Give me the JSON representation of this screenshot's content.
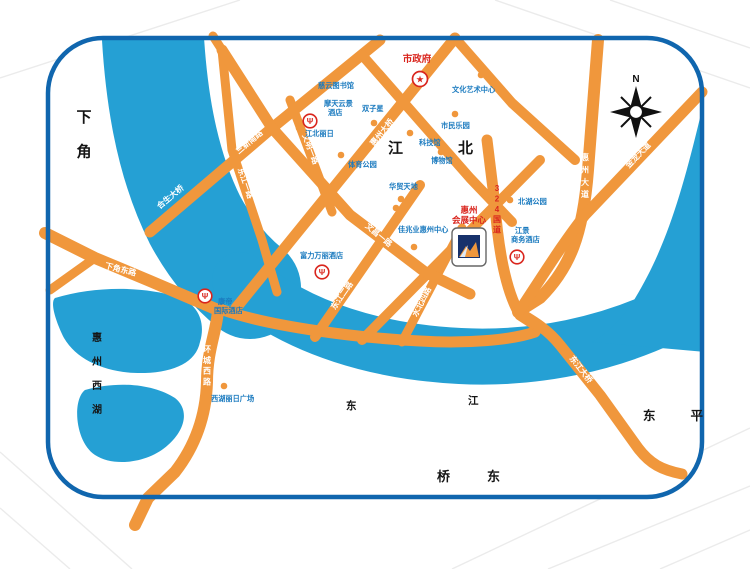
{
  "map": {
    "compass_label": "N",
    "icons": {
      "hotel_marker_glyph": "Ψ",
      "city_hall_star": "★"
    },
    "colors": {
      "border_blue": "#1066ae",
      "water_blue": "#25a0d4",
      "road_orange": "#f0973c",
      "poi_blue": "#1a7abf",
      "accent_red": "#d9251d"
    },
    "districts": {
      "xiajiao": "下角",
      "jiangbei": "江北",
      "qiaodong": "桥东",
      "dongping": "东平",
      "west_lake": "惠州西湖",
      "dongjiang_river": [
        "东",
        "江"
      ]
    },
    "roads": {
      "hesheng_bridge": "合生大桥",
      "sanxin_south_rd": "三新南路",
      "dongjiang_1st_rd": "东江一路",
      "huizhou_bridge": "惠州大桥",
      "wenming_1st_rd": "文明一路",
      "wenchang_1st_rd": "文昌一路",
      "dongjiang_2nd_rd": "东江二路",
      "xiajiao_east_rd": "下角东路",
      "huancheng_west_rd": "环城西路",
      "huizhou_avenue": "惠州大道",
      "jinlong_avenue": "金龙大道",
      "g324": "324国道",
      "shuibei_4th_rd": "水北四路",
      "dongjiang_bridge": "东江大桥"
    },
    "pois": {
      "city_hall": "市政府",
      "ciyun_library": "慈云图书馆",
      "culture_art_center": "文化艺术中心",
      "motian_hotel": [
        "摩天云景",
        "酒店"
      ],
      "twin_towers": "双子星",
      "jiangbei_liri": "江北丽日",
      "citizens_park": "市民乐园",
      "science_museum": "科技馆",
      "museum": "博物馆",
      "sports_park": "体育公园",
      "huamao_tiandi": "华贸天地",
      "kaisa_center": "佳兆业惠州中心",
      "convention_center": [
        "惠州",
        "会展中心"
      ],
      "north_lake_park": "北湖公园",
      "jiangjing_hotel": [
        "江景",
        "商务酒店"
      ],
      "rf_wanli_hotel": "富力万丽酒店",
      "kande_hotel": [
        "康帝",
        "国际酒店"
      ],
      "xihu_liri_plaza": "西湖丽日广场"
    }
  }
}
